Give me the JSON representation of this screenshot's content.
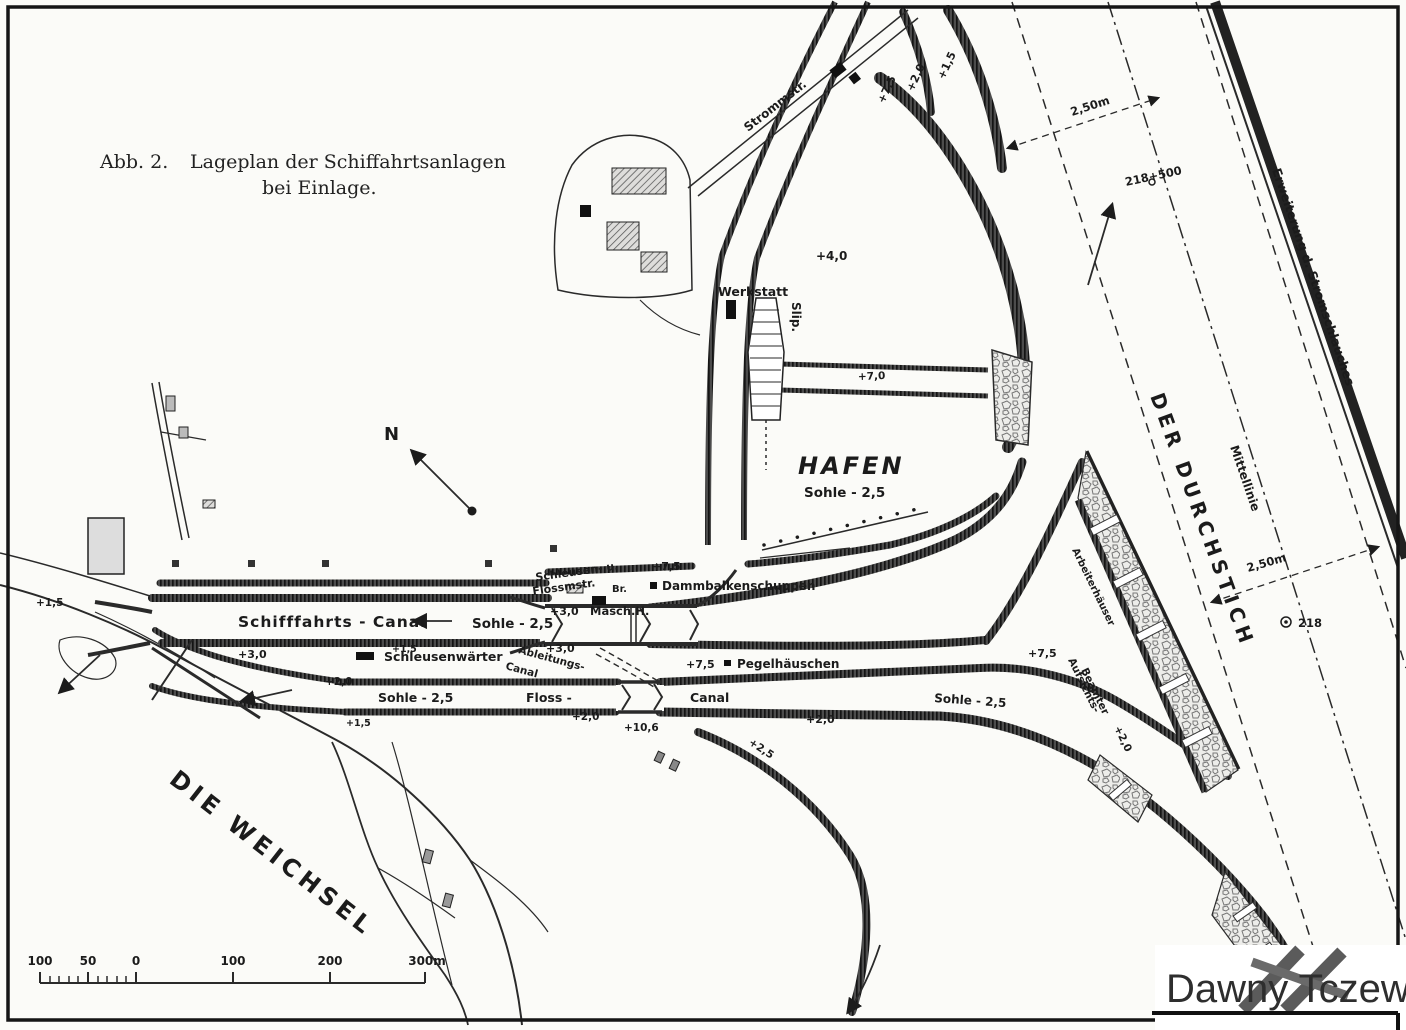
{
  "colors": {
    "ink": "#1c1c1c",
    "paper": "#fbfbf8",
    "stone_fill": "#ececea",
    "watermark_text": "#2e2e2e"
  },
  "figure": {
    "caption_prefix": "Abb. 2.",
    "caption_title": "Lageplan der Schiffahrtsanlagen",
    "caption_subtitle": "bei Einlage."
  },
  "compass": {
    "north": "N"
  },
  "waterways": {
    "river": "DIE WEICHSEL",
    "cut": "DER DURCHSTICH",
    "harbor": "HAFEN",
    "harbor_depth": "Sohle - 2,5",
    "ship_canal": "Schifffahrts - Canal",
    "ship_canal_depth": "Sohle - 2,5",
    "float_canal_west": "Floss -",
    "float_canal_east": "Canal",
    "float_canal_depth_west": "Sohle - 2,5",
    "float_canal_depth_east": "Sohle - 2,5",
    "diversion_canal_line1": "Ableitungs-",
    "diversion_canal_line2": "Canal",
    "widening_note": "Erweiterung d. Stromschlauches",
    "centerline_note": "Mittellinie"
  },
  "buildings": {
    "street": "Strommstr.",
    "workshop": "Werkstatt",
    "slipway": "Slip.",
    "machine_house": "Masch.H.",
    "lock_master_line1": "Schleusen- u.",
    "lock_master_line2": "Flossmstr.",
    "bridge": "Br.",
    "stoplog_shed": "Dammbalkenschuppen",
    "lock_keeper": "Schleusenwärter",
    "gauge_house": "Pegelhäuschen",
    "inspector_line1": "Aufsichts-",
    "inspector_line2": "Beamter",
    "workers_houses": "Arbeiterhäuser"
  },
  "elevations": {
    "top_75": "+7,5",
    "top_20": "+2,0",
    "top_15": "+1,5",
    "plateau_40": "+4,0",
    "harbor_quay_70": "+7,0",
    "lock_75": "+7,5",
    "machine_30": "+3,0",
    "south_30": "+3,0",
    "gauge_75": "+7,5",
    "entrance_15": "+1,5",
    "dike_15": "+1,5",
    "spit_30": "+3,0",
    "float_north_20": "+2,0",
    "float_mid_20": "+2,0",
    "float_low_15": "+1,5",
    "gauge_datum_106": "+10,6",
    "canal_east_20": "+2,0",
    "triangle_75": "+7,5",
    "dike_right_20": "+2,0",
    "dike_south_25": "+2,5"
  },
  "dimensions": {
    "upper_250": "2,50m",
    "lower_250": "2,50m",
    "station_upper": "218+500",
    "station_lower": "218"
  },
  "scale_bar": {
    "ticks": [
      "100",
      "50",
      "0",
      "100",
      "200",
      "300m"
    ]
  },
  "watermark": {
    "text": "Dawny Tczew"
  }
}
